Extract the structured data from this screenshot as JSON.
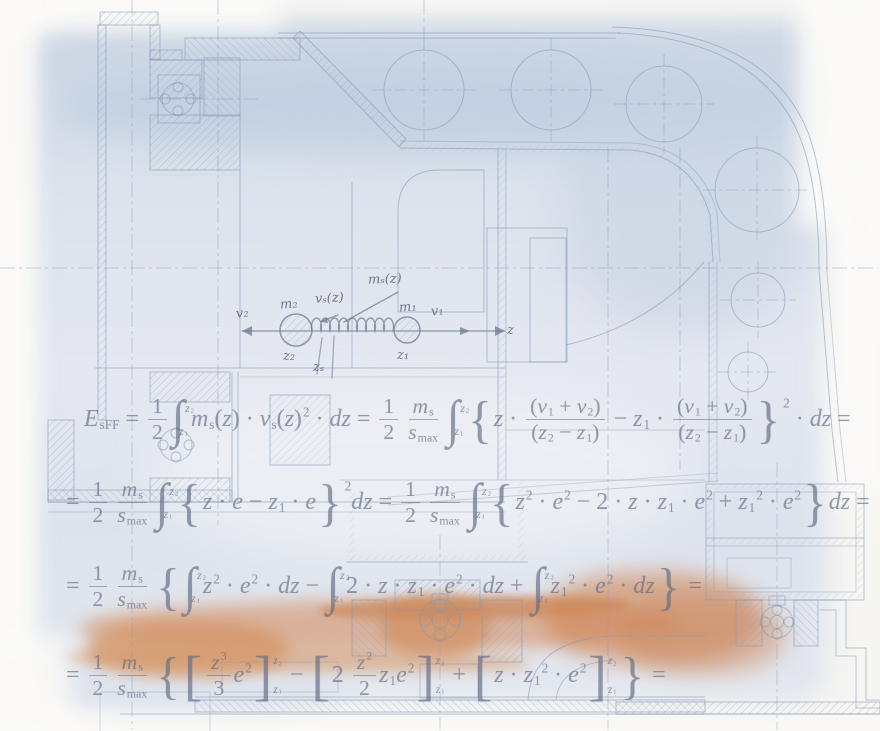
{
  "artwork": {
    "kind": "engineering-drawing-with-derivation",
    "colors": {
      "wash_blue": "#d6deea",
      "wash_blue_dark": "#c2cfe0",
      "wash_orange": "#d4895b",
      "drawing_line": "#8298b6",
      "formula_ink": "#626c85",
      "paper": "#f7f6f3"
    }
  },
  "spring_diagram": {
    "labels": {
      "v2": "v₂",
      "m2": "m₂",
      "vs": "vₛ(z)",
      "ms": "mₛ(z)",
      "m1": "m₁",
      "v1": "v₁",
      "z2": "z₂",
      "zs": "zₛ",
      "z1": "z₁",
      "z_axis": "z"
    }
  },
  "formulas": {
    "line1": [
      [
        "i",
        "E"
      ],
      [
        "dn",
        "sFF"
      ],
      [
        "r",
        " = "
      ],
      [
        "f",
        [
          [
            "r",
            "1"
          ]
        ],
        [
          [
            "r",
            "2"
          ]
        ]
      ],
      [
        "int",
        [
          [
            "i",
            "z"
          ],
          [
            "dn",
            "2"
          ]
        ],
        [
          [
            "i",
            "z"
          ],
          [
            "dn",
            "1"
          ]
        ]
      ],
      [
        "i",
        "m"
      ],
      [
        "dn",
        "s"
      ],
      [
        "r",
        "("
      ],
      [
        "i",
        "z"
      ],
      [
        "r",
        ")"
      ],
      [
        "r",
        " · "
      ],
      [
        "i",
        "v"
      ],
      [
        "dn",
        "s"
      ],
      [
        "r",
        "("
      ],
      [
        "i",
        "z"
      ],
      [
        "r",
        ")"
      ],
      [
        "up",
        "2"
      ],
      [
        "r",
        " · "
      ],
      [
        "i",
        "dz"
      ],
      [
        "r",
        " = "
      ],
      [
        "f",
        [
          [
            "r",
            "1"
          ]
        ],
        [
          [
            "r",
            "2"
          ]
        ]
      ],
      [
        "f",
        [
          [
            "i",
            "m"
          ],
          [
            "dn",
            "s"
          ]
        ],
        [
          [
            "i",
            "s"
          ],
          [
            "dn",
            "max"
          ]
        ]
      ],
      [
        "int",
        [
          [
            "i",
            "z"
          ],
          [
            "dn",
            "2"
          ]
        ],
        [
          [
            "i",
            "z"
          ],
          [
            "dn",
            "1"
          ]
        ]
      ],
      [
        "big",
        "{"
      ],
      [
        "i",
        "z"
      ],
      [
        "r",
        " · "
      ],
      [
        "f",
        [
          [
            "r",
            "("
          ],
          [
            "i",
            "v"
          ],
          [
            "dn",
            "1"
          ],
          [
            "r",
            " + "
          ],
          [
            "i",
            "v"
          ],
          [
            "dn",
            "2"
          ],
          [
            "r",
            ")"
          ]
        ],
        [
          [
            "r",
            "("
          ],
          [
            "i",
            "z"
          ],
          [
            "dn",
            "2"
          ],
          [
            "r",
            " − "
          ],
          [
            "i",
            "z"
          ],
          [
            "dn",
            "1"
          ],
          [
            "r",
            ")"
          ]
        ]
      ],
      [
        "r",
        " − "
      ],
      [
        "i",
        "z"
      ],
      [
        "dn",
        "1"
      ],
      [
        "r",
        " · "
      ],
      [
        "f",
        [
          [
            "r",
            "("
          ],
          [
            "i",
            "v"
          ],
          [
            "dn",
            "1"
          ],
          [
            "r",
            " + "
          ],
          [
            "i",
            "v"
          ],
          [
            "dn",
            "2"
          ],
          [
            "r",
            ")"
          ]
        ],
        [
          [
            "r",
            "("
          ],
          [
            "i",
            "z"
          ],
          [
            "dn",
            "2"
          ],
          [
            "r",
            " − "
          ],
          [
            "i",
            "z"
          ],
          [
            "dn",
            "1"
          ],
          [
            "r",
            ")"
          ]
        ]
      ],
      [
        "big",
        "}"
      ],
      [
        "hup",
        "2"
      ],
      [
        "r",
        " · "
      ],
      [
        "i",
        "dz"
      ],
      [
        "r",
        " = "
      ]
    ],
    "line2": [
      [
        "r",
        "= "
      ],
      [
        "f",
        [
          [
            "r",
            "1"
          ]
        ],
        [
          [
            "r",
            "2"
          ]
        ]
      ],
      [
        "f",
        [
          [
            "i",
            "m"
          ],
          [
            "dn",
            "s"
          ]
        ],
        [
          [
            "i",
            "s"
          ],
          [
            "dn",
            "max"
          ]
        ]
      ],
      [
        "int",
        [
          [
            "i",
            "z"
          ],
          [
            "dn",
            "2"
          ]
        ],
        [
          [
            "i",
            "z"
          ],
          [
            "dn",
            "1"
          ]
        ]
      ],
      [
        "big",
        "{"
      ],
      [
        "i",
        "z"
      ],
      [
        "r",
        " · "
      ],
      [
        "i",
        "e"
      ],
      [
        "r",
        " − "
      ],
      [
        "i",
        "z"
      ],
      [
        "dn",
        "1"
      ],
      [
        "r",
        " · "
      ],
      [
        "i",
        "e"
      ],
      [
        "big",
        "}"
      ],
      [
        "hup",
        "2"
      ],
      [
        "i",
        "dz"
      ],
      [
        "r",
        " = "
      ],
      [
        "f",
        [
          [
            "r",
            "1"
          ]
        ],
        [
          [
            "r",
            "2"
          ]
        ]
      ],
      [
        "f",
        [
          [
            "i",
            "m"
          ],
          [
            "dn",
            "s"
          ]
        ],
        [
          [
            "i",
            "s"
          ],
          [
            "dn",
            "max"
          ]
        ]
      ],
      [
        "int",
        [
          [
            "i",
            "z"
          ],
          [
            "dn",
            "2"
          ]
        ],
        [
          [
            "i",
            "z"
          ],
          [
            "dn",
            "1"
          ]
        ]
      ],
      [
        "big",
        "{"
      ],
      [
        "i",
        "z"
      ],
      [
        "up",
        "2"
      ],
      [
        "r",
        " · "
      ],
      [
        "i",
        "e"
      ],
      [
        "up",
        "2"
      ],
      [
        "r",
        " − 2 · "
      ],
      [
        "i",
        "z"
      ],
      [
        "r",
        " · "
      ],
      [
        "i",
        "z"
      ],
      [
        "dn",
        "1"
      ],
      [
        "r",
        " · "
      ],
      [
        "i",
        "e"
      ],
      [
        "up",
        "2"
      ],
      [
        "r",
        " + "
      ],
      [
        "i",
        "z"
      ],
      [
        "dn",
        "1"
      ],
      [
        "up",
        "2"
      ],
      [
        "r",
        " · "
      ],
      [
        "i",
        "e"
      ],
      [
        "up",
        "2"
      ],
      [
        "big",
        "}"
      ],
      [
        "i",
        "dz"
      ],
      [
        "r",
        " = "
      ]
    ],
    "line3": [
      [
        "r",
        "= "
      ],
      [
        "f",
        [
          [
            "r",
            "1"
          ]
        ],
        [
          [
            "r",
            "2"
          ]
        ]
      ],
      [
        "f",
        [
          [
            "i",
            "m"
          ],
          [
            "dn",
            "s"
          ]
        ],
        [
          [
            "i",
            "s"
          ],
          [
            "dn",
            "max"
          ]
        ]
      ],
      [
        "big",
        "{"
      ],
      [
        "int",
        [
          [
            "i",
            "z"
          ],
          [
            "dn",
            "2"
          ]
        ],
        [
          [
            "i",
            "z"
          ],
          [
            "dn",
            "1"
          ]
        ]
      ],
      [
        "i",
        "z"
      ],
      [
        "up",
        "2"
      ],
      [
        "r",
        " · "
      ],
      [
        "i",
        "e"
      ],
      [
        "up",
        "2"
      ],
      [
        "r",
        " · "
      ],
      [
        "i",
        "dz"
      ],
      [
        "r",
        " − "
      ],
      [
        "int",
        [
          [
            "i",
            "z"
          ],
          [
            "dn",
            "2"
          ]
        ],
        [
          [
            "i",
            "z"
          ],
          [
            "dn",
            "1"
          ]
        ]
      ],
      [
        "r",
        "2 · "
      ],
      [
        "i",
        "z"
      ],
      [
        "r",
        " · "
      ],
      [
        "i",
        "z"
      ],
      [
        "dn",
        "1"
      ],
      [
        "r",
        " · "
      ],
      [
        "i",
        "e"
      ],
      [
        "up",
        "2"
      ],
      [
        "r",
        " · "
      ],
      [
        "i",
        "dz"
      ],
      [
        "r",
        " + "
      ],
      [
        "int",
        [
          [
            "i",
            "z"
          ],
          [
            "dn",
            "2"
          ]
        ],
        [
          [
            "i",
            "z"
          ],
          [
            "dn",
            "1"
          ]
        ]
      ],
      [
        "i",
        "z"
      ],
      [
        "dn",
        "1"
      ],
      [
        "up",
        "2"
      ],
      [
        "r",
        " · "
      ],
      [
        "i",
        "e"
      ],
      [
        "up",
        "2"
      ],
      [
        "r",
        " · "
      ],
      [
        "i",
        "dz"
      ],
      [
        "big",
        "}"
      ],
      [
        "r",
        " = "
      ]
    ],
    "line4": [
      [
        "r",
        "= "
      ],
      [
        "f",
        [
          [
            "r",
            "1"
          ]
        ],
        [
          [
            "r",
            "2"
          ]
        ]
      ],
      [
        "f",
        [
          [
            "i",
            "m"
          ],
          [
            "dn",
            "s"
          ]
        ],
        [
          [
            "i",
            "s"
          ],
          [
            "dn",
            "max"
          ]
        ]
      ],
      [
        "big",
        "{"
      ],
      [
        "ev",
        [
          [
            "f",
            [
              [
                "i",
                "z"
              ],
              [
                "up",
                "3"
              ]
            ],
            [
              [
                "r",
                "3"
              ]
            ]
          ],
          [
            "i",
            "e"
          ],
          [
            "up",
            "2"
          ]
        ],
        [
          [
            "i",
            "z"
          ],
          [
            "dn",
            "2"
          ]
        ],
        [
          [
            "i",
            "z"
          ],
          [
            "dn",
            "1"
          ]
        ]
      ],
      [
        "r",
        " − "
      ],
      [
        "ev",
        [
          [
            "r",
            "2 "
          ],
          [
            "f",
            [
              [
                "i",
                "z"
              ],
              [
                "up",
                "2"
              ]
            ],
            [
              [
                "r",
                "2"
              ]
            ]
          ],
          [
            "i",
            "z"
          ],
          [
            "dn",
            "1"
          ],
          [
            "i",
            "e"
          ],
          [
            "up",
            "2"
          ]
        ],
        [
          [
            "i",
            "z"
          ],
          [
            "dn",
            "2"
          ]
        ],
        [
          [
            "i",
            "z"
          ],
          [
            "dn",
            "1"
          ]
        ]
      ],
      [
        "r",
        " + "
      ],
      [
        "ev",
        [
          [
            "i",
            "z"
          ],
          [
            "r",
            " · "
          ],
          [
            "i",
            "z"
          ],
          [
            "dn",
            "1"
          ],
          [
            "up",
            "2"
          ],
          [
            "r",
            " · "
          ],
          [
            "i",
            "e"
          ],
          [
            "up",
            "2"
          ]
        ],
        [
          [
            "i",
            "z"
          ],
          [
            "dn",
            "2"
          ]
        ],
        [
          [
            "i",
            "z"
          ],
          [
            "dn",
            "1"
          ]
        ]
      ],
      [
        "big",
        "}"
      ],
      [
        "r",
        " = "
      ]
    ]
  }
}
